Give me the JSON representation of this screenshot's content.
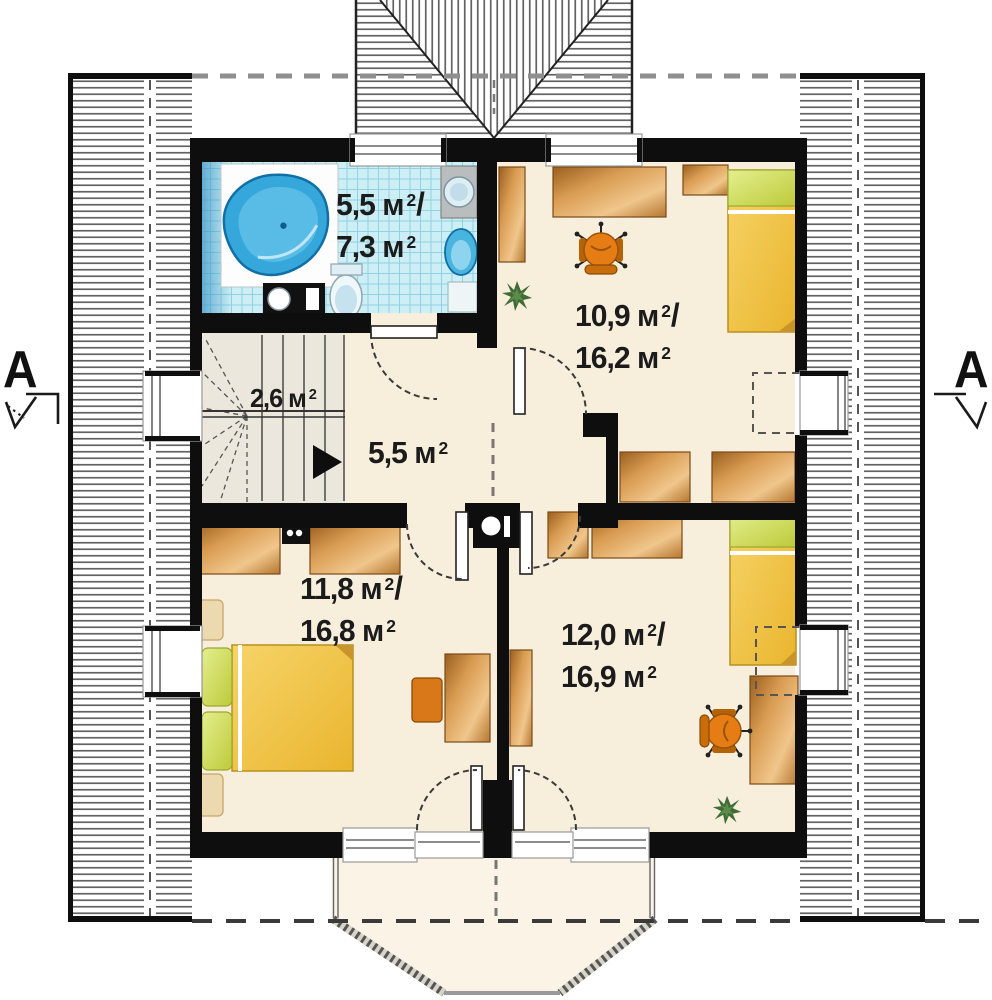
{
  "title": "Attic floor plan",
  "palette": {
    "floor": "#f8eedc",
    "floor_light": "#faf3e6",
    "wall": "#0e0e0e",
    "tile_bg": "#cdeef5",
    "tile_line": "#8fd2e2",
    "tub": "#36a7da",
    "tub_dark": "#0f6fa6",
    "tub_light": "#84d2ef",
    "chair": "#e67d14",
    "chair_dark": "#9c5207",
    "bed_yellow": "#f2c341",
    "pillow_green": "#cdd84f",
    "plant": "#3f6b35",
    "stair_floor": "#ece7dc",
    "fixture_blue": "#49b4dd",
    "counter_gray": "#b9bdbd",
    "dash": "#8f8f8f",
    "text": "#1b1b1b"
  },
  "labels": {
    "bathroom": {
      "v1": "5,5 м",
      "v2": "7,3 м",
      "sup": "2",
      "slash": "/"
    },
    "room_top_right": {
      "v1": "10,9 м",
      "v2": "16,2 м",
      "sup": "2",
      "slash": "/"
    },
    "stairs": {
      "v1": "2,6 м",
      "sup": "2"
    },
    "hall": {
      "v1": "5,5 м",
      "sup": "2"
    },
    "bedroom": {
      "v1": "11,8 м",
      "v2": "16,8 м",
      "sup": "2",
      "slash": "/"
    },
    "room_bottom_right": {
      "v1": "12,0 м",
      "v2": "16,9 м",
      "sup": "2",
      "slash": "/"
    }
  },
  "markers": {
    "left": "A",
    "right": "A"
  }
}
